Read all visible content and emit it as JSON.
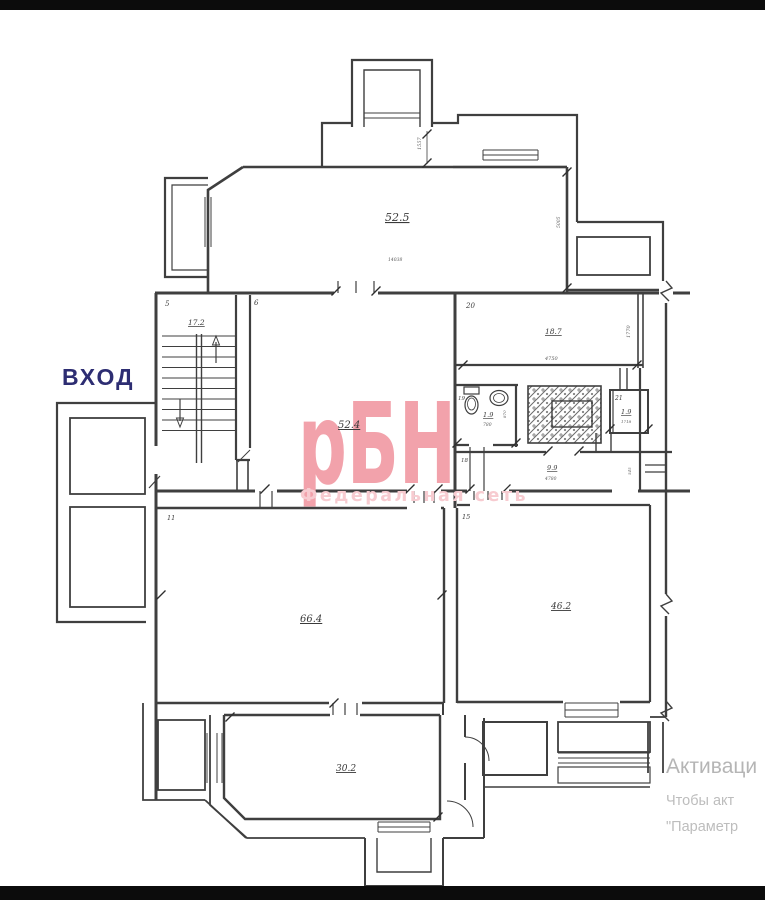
{
  "colors": {
    "wall": "#3f3f3f",
    "label": "#3a3a3a",
    "watermark_logo": "#f2a2ab",
    "watermark_sub": "#f7cbd0",
    "entrance": "#2d2d72",
    "activation": "#b5b5b5",
    "letterbox": "#0c0c0c"
  },
  "entrance": {
    "label": "ВХОД"
  },
  "watermark": {
    "logo": "рБН",
    "subtitle": "Федеральная сеть"
  },
  "activation": {
    "line1": "Активаци",
    "line2": "Чтобы акт",
    "line3": "\"Параметр"
  },
  "rooms": {
    "r525": {
      "area": "52.5"
    },
    "r5": {
      "number": "5",
      "area": "17.2"
    },
    "r6": {
      "number": "6",
      "area": "52.4"
    },
    "r20": {
      "number": "20",
      "area": "18.7",
      "width": "4750",
      "height": "1770"
    },
    "r19": {
      "number": "19",
      "area": "1.9",
      "width": "780",
      "height": "870"
    },
    "r21": {
      "number": "21",
      "area": "1.9",
      "width": "1718"
    },
    "r18": {
      "number": "18",
      "area": "9.9",
      "width": "4780",
      "height": "545"
    },
    "r11": {
      "number": "11",
      "area": "66.4"
    },
    "r15": {
      "number": "15",
      "area": "46.2"
    },
    "r302": {
      "area": "30.2"
    }
  },
  "dims": {
    "vestibule_recess": "1557",
    "main_width": "14038",
    "right_height": "5005"
  }
}
